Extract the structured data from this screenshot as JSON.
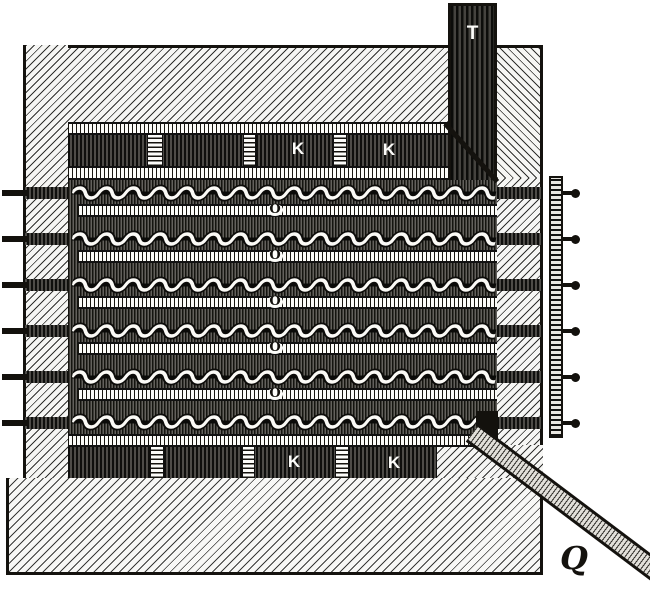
{
  "figure": {
    "description": "Sectional engraving of a multi-deck screw-conveyor drying apparatus with flue, perforated heating chambers and discharge chute",
    "colors": {
      "ink": "#14120e",
      "paper": "#ffffff"
    },
    "labels": {
      "flue": "T",
      "upper_chamber_k": [
        "K",
        "K"
      ],
      "lower_chamber_k": [
        "K",
        "K"
      ],
      "conveyor_shelves": [
        "O",
        "O",
        "O",
        "O",
        "O"
      ],
      "discharge_chute": "Q"
    },
    "counts": {
      "screw_conveyors": 6,
      "shelf_bars": 5,
      "shaft_ends_left": 6,
      "shaft_ends_right": 6,
      "grille_vents_upper": 3,
      "grille_vents_lower": 3
    }
  }
}
